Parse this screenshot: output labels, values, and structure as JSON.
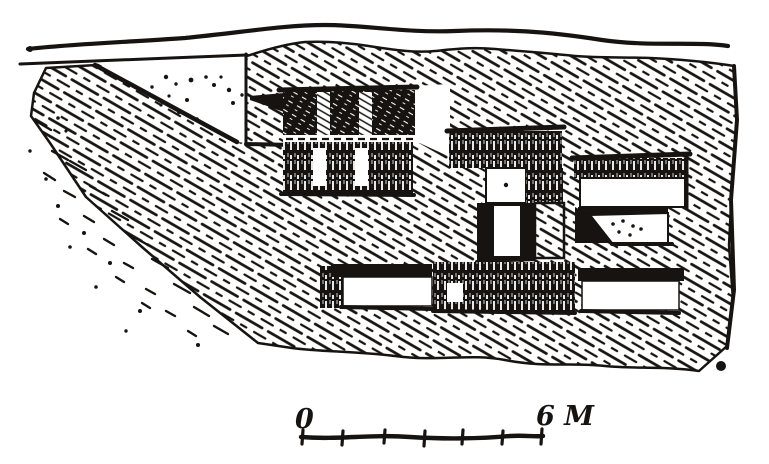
{
  "figure": {
    "description": "Hand-drawn pen-and-ink excavation section: hatched earth slope with buried masonry blocks",
    "ink_color": "#171310",
    "paper_color": "#ffffff"
  },
  "scale_bar": {
    "zero_label": "0",
    "end_label": "6 M",
    "divisions": 6
  }
}
